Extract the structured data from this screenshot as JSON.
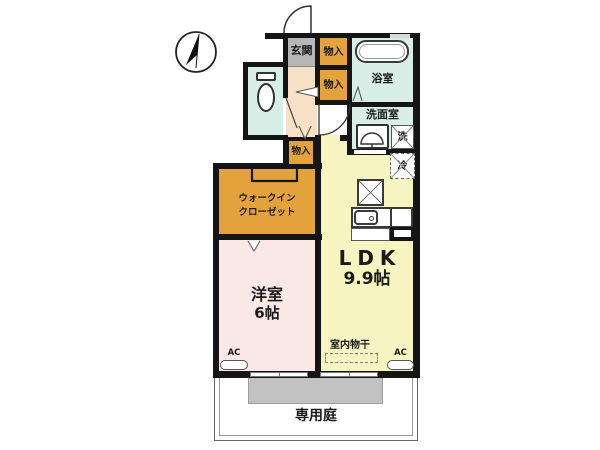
{
  "compass": {
    "name": "north-arrow"
  },
  "rooms": {
    "genkan": {
      "label": "玄関"
    },
    "storage_top": {
      "label": "物入"
    },
    "storage_mid": {
      "label": "物入"
    },
    "storage_hall": {
      "label": "物入"
    },
    "bathroom": {
      "label": "浴室"
    },
    "washroom": {
      "label": "洗面室"
    },
    "walkin_closet": {
      "line1": "ウォークイン",
      "line2": "クローゼット"
    },
    "ldk": {
      "label": "LDK",
      "size": "9.9帖"
    },
    "western_room": {
      "label": "洋室",
      "size": "6帖"
    },
    "garden": {
      "label": "専用庭"
    }
  },
  "fixtures": {
    "washer_label": "洗",
    "fridge_label": "冷",
    "indoor_drying_label": "室内物干",
    "ac_left_label": "AC",
    "ac_right_label": "AC"
  },
  "colors": {
    "wall": "#151515",
    "mint": "#d7efe7",
    "orange": "#e3a23c",
    "genkan_gray": "#b7b7b7",
    "hall_peach": "#f8e0c7",
    "ldk_yellow": "#f6f4c0",
    "bedroom_pink": "#f9e8e5",
    "terrace_gray": "#c2c2c2"
  }
}
